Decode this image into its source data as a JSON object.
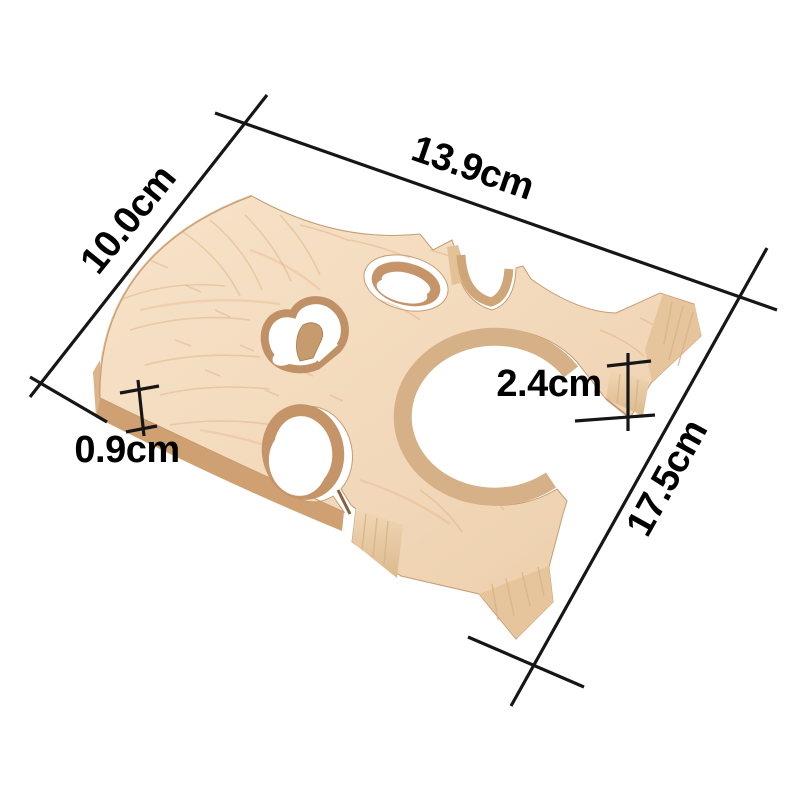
{
  "diagram": {
    "background": "#ffffff",
    "subject": "wooden cello bridge blank, maple, lying at an angle on white background",
    "annotation": {
      "line_color": "#161616",
      "text_color": "#000000"
    },
    "wood_colors": {
      "top_face": "#f3dcc0",
      "top_face_shadow": "#eccfab",
      "side_walls": "#c59569",
      "end_grain": "#e6c59d",
      "bottom_band": "#cfa072"
    },
    "dimensions": {
      "top_width": {
        "label": "13.9cm"
      },
      "left_width": {
        "label": "10.0cm"
      },
      "length": {
        "label": "17.5cm"
      },
      "foot_height": {
        "label": "2.4cm"
      },
      "plate_thickness": {
        "label": "0.9cm"
      }
    }
  }
}
